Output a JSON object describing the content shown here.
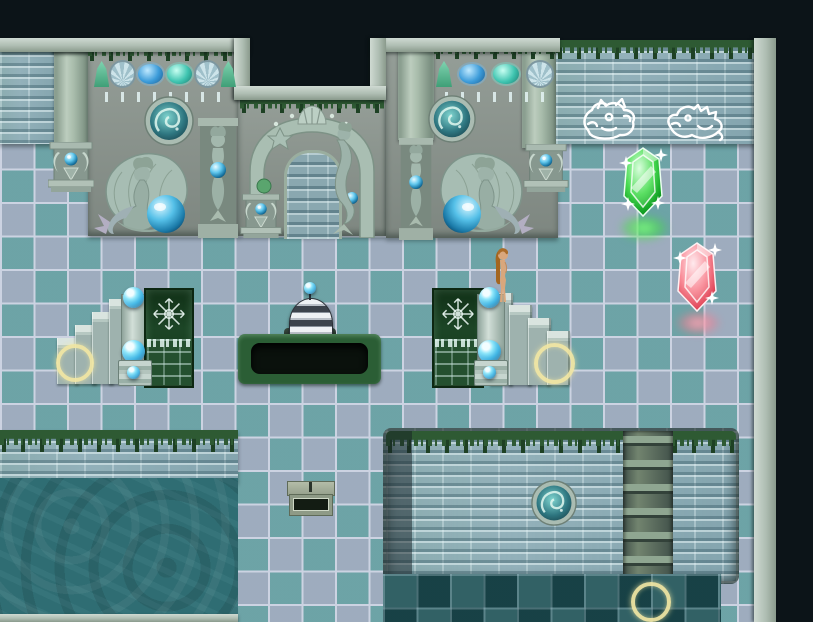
{
  "scene": {
    "width": 622,
    "height": 622,
    "description": "Top-down RPG map: sunken mermaid shrine with glass-tile floor, mermaid statues, gem altars, two elemental crystals, orb pedestals, stairs, a dark pit with a striped device, a water pool and a sunken brick chamber with ladder"
  },
  "palette": {
    "void": "#0c1418",
    "tile_light": "#a7b3c2",
    "tile_teal": "#4f9e9a",
    "tile_dark": "#2b595d",
    "grout": "#ccd3e2",
    "brick": "#93b1ba",
    "panel": "#8c968f",
    "ledge_light": "#cfdad2",
    "ledge_dark": "#8a9a8c",
    "moss": "#2e5a33",
    "moss_dark": "#1e4124",
    "water": "#2f6d73",
    "pit_rim": "#2b5e35",
    "pit_hole": "#0a110c",
    "gate_green": "#1c4526",
    "orb_blue": "#3db4e4",
    "crystal_green": "#2fd13f",
    "crystal_green_glow": "#66e866",
    "crystal_red": "#ef6e7c",
    "crystal_red_glow": "#ffa9bb",
    "ring_yellow": "#f2e7a4",
    "statue_stone": "#a7bdb3",
    "statue_shade": "#7e948a",
    "skin": "#d9a77c",
    "hair": "#ab6c28",
    "metal_light": "#eef1f4",
    "metal_dark": "#3c434c",
    "chalk_white": "#ffffff"
  },
  "objects": {
    "player": {
      "label": "player-character"
    },
    "crystals": [
      {
        "label": "green-crystal",
        "color": "#2fd13f"
      },
      {
        "label": "red-crystal",
        "color": "#ef6e7c"
      }
    ],
    "event_rings": {
      "count": 3,
      "color": "#f2e7a4"
    },
    "orb_switches": {
      "count": 7,
      "color": "#3db4e4"
    },
    "wall_drawings": [
      {
        "label": "horse-spirit-drawing"
      },
      {
        "label": "seahorse-spirit-drawing"
      }
    ],
    "statues": [
      {
        "label": "mermaid-shell-statue-left"
      },
      {
        "label": "mermaid-shell-statue-right"
      },
      {
        "label": "mermaid-caryatid-left"
      },
      {
        "label": "mermaid-caryatid-right"
      },
      {
        "label": "arch-mermaid"
      }
    ],
    "fixtures": [
      {
        "label": "striped-device"
      },
      {
        "label": "stone-sign"
      },
      {
        "label": "ladder"
      },
      {
        "label": "ice-gate-left"
      },
      {
        "label": "ice-gate-right"
      },
      {
        "label": "dark-pit"
      },
      {
        "label": "gem-altar",
        "count": 3
      },
      {
        "label": "porthole-window",
        "count": 3
      }
    ]
  }
}
